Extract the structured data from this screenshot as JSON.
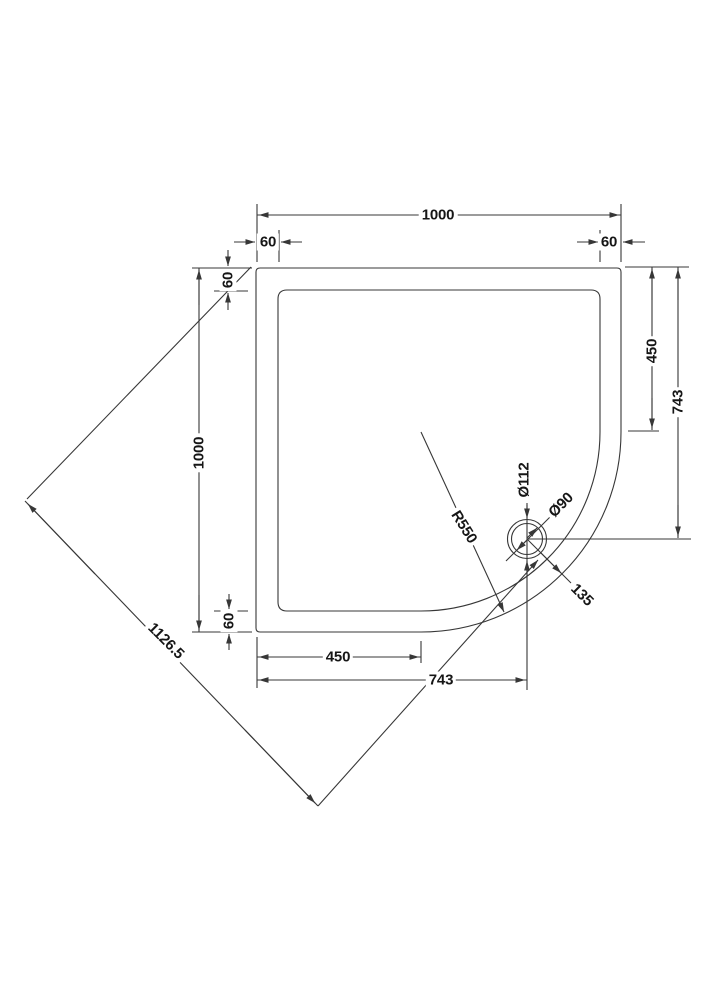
{
  "drawing": {
    "type": "technical-dimension-drawing",
    "subject": "Quadrant shower tray plan view with waste position",
    "line_color": "#373737",
    "text_color": "#161616",
    "labels": {
      "top_width": "1000",
      "top_offset_left": "60",
      "top_offset_right": "60",
      "left_height": "1000",
      "left_offset_top": "60",
      "left_offset_bottom": "60",
      "right_curve_start": "450",
      "right_drain_offset": "743",
      "bottom_curve_start": "450",
      "bottom_drain_offset": "743",
      "diagonal_width": "1126.5",
      "corner_radius": "R550",
      "waste_outer_diameter": "Ø112",
      "waste_inner_diameter": "Ø90",
      "waste_to_corner": "135"
    }
  }
}
